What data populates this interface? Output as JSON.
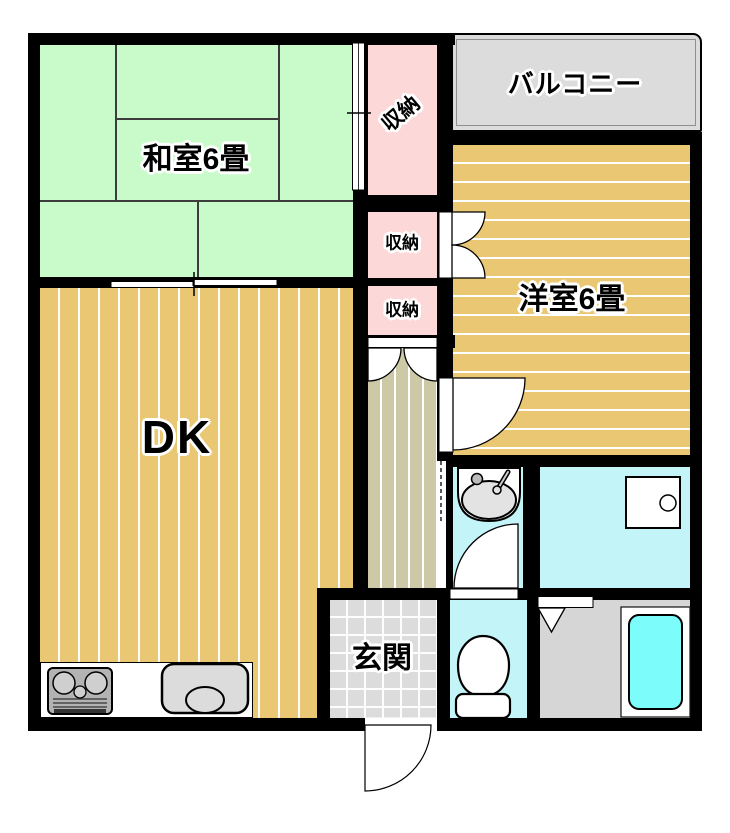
{
  "rooms": {
    "washitsu": {
      "label": "和室6畳"
    },
    "balcony": {
      "label": "バルコニー"
    },
    "youshitsu": {
      "label": "洋室6畳"
    },
    "dk": {
      "label": "DK"
    },
    "closet_top": {
      "label": "収納"
    },
    "closet_mid": {
      "label": "収納"
    },
    "closet_bottom": {
      "label": "収納"
    },
    "genkan": {
      "label": "玄関"
    }
  },
  "fixtures": {
    "stove": "gas-stove",
    "kitchen_sink": "kitchen-sink",
    "washbasin": "washbasin",
    "washing_machine": "washing-machine-pan",
    "toilet": "toilet",
    "bathtub": "bathtub"
  },
  "colors": {
    "tatami_green": "#c9fbca",
    "wood_gold": "#eac873",
    "closet_pink": "#fdd8d8",
    "hall_beige": "#cdc8a6",
    "tile_gray": "#dcdcdc",
    "wet_cyan": "#c2f4f8",
    "bath_gray": "#d6d6d6",
    "tub_cyan": "#7dfcfc",
    "wall_black": "#000000"
  }
}
